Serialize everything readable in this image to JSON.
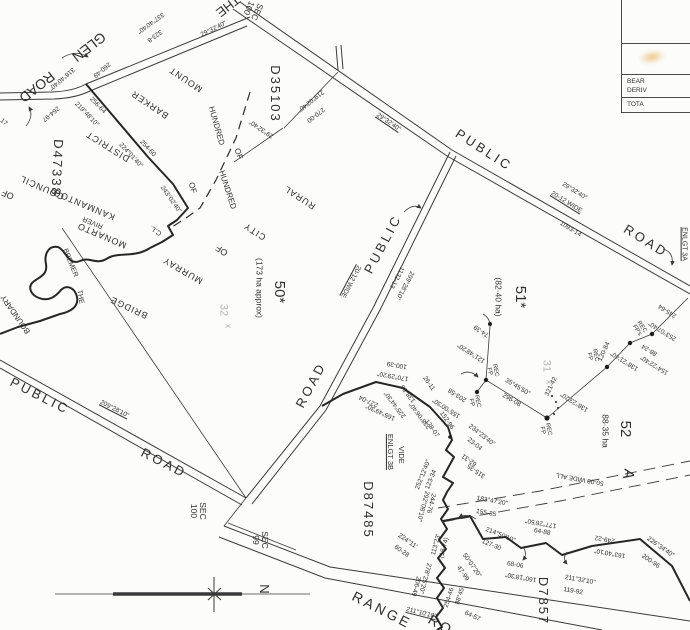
{
  "map": {
    "background": "#fcfcfb",
    "ink": "#2e2e2e",
    "faint_ink": "#b5b5b5",
    "smudge_color": "#e09628",
    "corner_table": {
      "row2_line1": "BEAR",
      "row2_line2": "DERIV",
      "row3": "TOTA"
    },
    "labels": [
      {
        "t": "THE",
        "x": 228,
        "y": 6,
        "r": 142,
        "s": 13
      },
      {
        "t": "GLEN",
        "x": 89,
        "y": 47,
        "r": 142,
        "s": 14
      },
      {
        "t": "ROAD",
        "x": 37,
        "y": 87,
        "r": 142,
        "s": 14
      },
      {
        "t": "337°40'40\"",
        "x": 150,
        "y": 22,
        "r": 144,
        "s": 6.5
      },
      {
        "t": "323-8",
        "x": 154,
        "y": 35,
        "r": 144,
        "s": 6.5
      },
      {
        "t": "316°40'40\"",
        "x": 61,
        "y": 78,
        "r": 140,
        "s": 6.5
      },
      {
        "t": "260-49",
        "x": 101,
        "y": 69,
        "r": 140,
        "s": 6.5
      },
      {
        "t": "264-97",
        "x": 50,
        "y": 113,
        "r": 140,
        "s": 6.5
      },
      {
        "t": "29°32'40\"",
        "x": 214,
        "y": 30,
        "r": -26,
        "s": 6.5
      },
      {
        "t": "SEC\n100",
        "x": 253,
        "y": 10,
        "r": 115,
        "s": 8.5
      },
      {
        "t": "D35103",
        "x": 275,
        "y": 94,
        "r": 90,
        "s": 13,
        "ls": 2
      },
      {
        "t": "219°02'40\"",
        "x": 310,
        "y": 100,
        "r": 142,
        "s": 6.5
      },
      {
        "t": "270-00",
        "x": 315,
        "y": 114,
        "r": 142,
        "s": 6.5
      },
      {
        "t": "29°32'40\"",
        "x": 262,
        "y": 128,
        "r": 214,
        "s": 6.5
      },
      {
        "t": "29°32'40\"",
        "x": 388,
        "y": 123,
        "r": 34,
        "s": 6.5,
        "u": 1
      },
      {
        "t": "PUBLIC",
        "x": 484,
        "y": 150,
        "r": 33,
        "s": 13,
        "ls": 3
      },
      {
        "t": "ROAD",
        "x": 646,
        "y": 241,
        "r": 32,
        "s": 13,
        "ls": 3
      },
      {
        "t": "29°32'40\"",
        "x": 574,
        "y": 192,
        "r": 32,
        "s": 6.5
      },
      {
        "t": "20-12 WIDE",
        "x": 566,
        "y": 203,
        "r": 32,
        "s": 6.5,
        "u": 1
      },
      {
        "t": "1093-14",
        "x": 570,
        "y": 230,
        "r": 32,
        "s": 6.5
      },
      {
        "t": "ENLGT 3A",
        "x": 684,
        "y": 244,
        "r": 90,
        "s": 7,
        "u": 1
      },
      {
        "t": "PUBLIC",
        "x": 383,
        "y": 244,
        "r": -62,
        "s": 13,
        "ls": 3
      },
      {
        "t": "ROAD",
        "x": 311,
        "y": 385,
        "r": -62,
        "s": 13,
        "ls": 3
      },
      {
        "t": "20-12 WIDE",
        "x": 350,
        "y": 281,
        "r": 118,
        "s": 6.5,
        "u": 1
      },
      {
        "t": "1132-13",
        "x": 396,
        "y": 277,
        "r": 118,
        "s": 6.5
      },
      {
        "t": "299°28'10\"",
        "x": 404,
        "y": 285,
        "r": 118,
        "s": 6.5
      },
      {
        "t": "PUBLIC",
        "x": 40,
        "y": 396,
        "r": 27,
        "s": 13,
        "ls": 3
      },
      {
        "t": "ROAD",
        "x": 164,
        "y": 463,
        "r": 27,
        "s": 13,
        "ls": 3
      },
      {
        "t": "209°28'10\"",
        "x": 114,
        "y": 410,
        "r": 27,
        "s": 6.5,
        "u": 1
      },
      {
        "t": "RANGE",
        "x": 382,
        "y": 610,
        "r": 27,
        "s": 14,
        "ls": 3
      },
      {
        "t": "RO",
        "x": 441,
        "y": 625,
        "r": 30,
        "s": 14,
        "ls": 3
      },
      {
        "t": "211°10'10\"",
        "x": 421,
        "y": 614,
        "r": 14,
        "s": 6.5,
        "u": 1
      },
      {
        "t": "50*",
        "x": 279,
        "y": 292,
        "r": 90,
        "s": 15
      },
      {
        "t": "(173 ha approx)",
        "x": 259,
        "y": 288,
        "r": 90,
        "s": 8.5
      },
      {
        "t": "51*",
        "x": 520,
        "y": 297,
        "r": 90,
        "s": 15
      },
      {
        "t": "(82·40 ha)",
        "x": 498,
        "y": 297,
        "r": 90,
        "s": 8.5
      },
      {
        "t": "52",
        "x": 625,
        "y": 429,
        "r": 90,
        "s": 15
      },
      {
        "t": "88·35 ha",
        "x": 605,
        "y": 431,
        "r": 90,
        "s": 8.5
      },
      {
        "t": "32",
        "x": 223,
        "y": 310,
        "r": 90,
        "s": 11,
        "c": "#b5b5b5"
      },
      {
        "t": "x",
        "x": 228,
        "y": 326,
        "r": 90,
        "s": 9,
        "c": "#b5b5b5"
      },
      {
        "t": "31",
        "x": 546,
        "y": 366,
        "r": 90,
        "s": 11,
        "c": "#b5b5b5"
      },
      {
        "t": "x",
        "x": 549,
        "y": 382,
        "r": 90,
        "s": 9,
        "c": "#b5b5b5"
      },
      {
        "t": "SEC\n100",
        "x": 198,
        "y": 511,
        "r": 90,
        "s": 8.5
      },
      {
        "t": "SEC\n99",
        "x": 260,
        "y": 540,
        "r": 90,
        "s": 8.5
      },
      {
        "t": "D47338",
        "x": 57,
        "y": 168,
        "r": 93,
        "s": 13,
        "ls": 2
      },
      {
        "t": "D87485",
        "x": 368,
        "y": 510,
        "r": 90,
        "s": 13,
        "ls": 2
      },
      {
        "t": "D7857",
        "x": 543,
        "y": 601,
        "r": 90,
        "s": 13,
        "ls": 2
      },
      {
        "t": "VIDE",
        "x": 401,
        "y": 455,
        "r": 90,
        "s": 7.5
      },
      {
        "t": "ENLGT 3B",
        "x": 390,
        "y": 452,
        "r": 90,
        "s": 7.5,
        "u": 1
      },
      {
        "t": "A",
        "x": 628,
        "y": 474,
        "r": 100,
        "s": 15
      },
      {
        "t": "50-00 WIDE ALL",
        "x": 580,
        "y": 478,
        "r": 190,
        "s": 6.5
      },
      {
        "t": "MOUNT",
        "x": 186,
        "y": 79,
        "r": 214,
        "s": 9,
        "ls": 1
      },
      {
        "t": "BARKER",
        "x": 150,
        "y": 104,
        "r": 214,
        "s": 9,
        "ls": 1
      },
      {
        "t": "DISTRICT",
        "x": 108,
        "y": 146,
        "r": 212,
        "s": 9,
        "ls": 1
      },
      {
        "t": "COUNCIL",
        "x": 42,
        "y": 187,
        "r": 204,
        "s": 9,
        "ls": 1
      },
      {
        "t": "OF",
        "x": 8,
        "y": 194,
        "r": 204,
        "s": 9
      },
      {
        "t": "HUNDRED",
        "x": 216,
        "y": 126,
        "r": 74,
        "s": 8
      },
      {
        "t": "OF",
        "x": 238,
        "y": 154,
        "r": 72,
        "s": 8
      },
      {
        "t": "HUNDRED",
        "x": 227,
        "y": 190,
        "r": 72,
        "s": 8
      },
      {
        "t": "OF",
        "x": 192,
        "y": 188,
        "r": 74,
        "s": 8
      },
      {
        "t": "KANMANTOO",
        "x": 84,
        "y": 204,
        "r": 203,
        "s": 9,
        "ls": 1
      },
      {
        "t": "MONARTO",
        "x": 102,
        "y": 235,
        "r": 203,
        "s": 9,
        "ls": 1
      },
      {
        "t": "RIVER",
        "x": 93,
        "y": 222,
        "r": 203,
        "s": 7
      },
      {
        "t": "BREMER",
        "x": 70,
        "y": 263,
        "r": 68,
        "s": 7
      },
      {
        "t": "THE",
        "x": 80,
        "y": 297,
        "r": 80,
        "s": 7
      },
      {
        "t": "BOUNDARY",
        "x": 16,
        "y": 314,
        "r": 235,
        "s": 8
      },
      {
        "t": "C.L.",
        "x": 156,
        "y": 230,
        "r": 214,
        "s": 7
      },
      {
        "t": "RURAL",
        "x": 300,
        "y": 197,
        "r": 213,
        "s": 9,
        "ls": 1
      },
      {
        "t": "CITY",
        "x": 255,
        "y": 231,
        "r": 213,
        "s": 9,
        "ls": 1
      },
      {
        "t": "OF",
        "x": 222,
        "y": 250,
        "r": 213,
        "s": 9
      },
      {
        "t": "MURRAY",
        "x": 183,
        "y": 270,
        "r": 210,
        "s": 9,
        "ls": 1
      },
      {
        "t": "BRIDGE",
        "x": 129,
        "y": 307,
        "r": 205,
        "s": 9,
        "ls": 1
      },
      {
        "t": "243°02'40\"",
        "x": 170,
        "y": 200,
        "r": 55,
        "s": 6.5
      },
      {
        "t": "256-64",
        "x": 97,
        "y": 106,
        "r": 46,
        "s": 6.5
      },
      {
        "t": "219°48'10\"",
        "x": 86,
        "y": 115,
        "r": 46,
        "s": 6.5
      },
      {
        "t": "254-60",
        "x": 147,
        "y": 149,
        "r": 47,
        "s": 6.5
      },
      {
        "t": "224°01'40\"",
        "x": 130,
        "y": 156,
        "r": 47,
        "s": 6.5
      },
      {
        "t": "17",
        "x": 3,
        "y": 123,
        "r": 40,
        "s": 6.5
      },
      {
        "t": "170°29'20\"",
        "x": 393,
        "y": 375,
        "r": 190,
        "s": 6.5
      },
      {
        "t": "100-39",
        "x": 397,
        "y": 364,
        "r": 190,
        "s": 6.5
      },
      {
        "t": "227-04",
        "x": 369,
        "y": 400,
        "r": 205,
        "s": 6.5
      },
      {
        "t": "165°49'30\"",
        "x": 381,
        "y": 411,
        "r": 205,
        "s": 6.5
      },
      {
        "t": "138-86",
        "x": 409,
        "y": 393,
        "r": 233,
        "s": 6.5
      },
      {
        "t": "225°44'30\"",
        "x": 396,
        "y": 404,
        "r": 233,
        "s": 6.5
      },
      {
        "t": "238°06'40\"",
        "x": 421,
        "y": 415,
        "r": 233,
        "s": 6.5
      },
      {
        "t": "26-11",
        "x": 428,
        "y": 384,
        "r": 55,
        "s": 6.5
      },
      {
        "t": "203-58",
        "x": 458,
        "y": 394,
        "r": 213,
        "s": 6.5
      },
      {
        "t": "155°00'30\"",
        "x": 447,
        "y": 407,
        "r": 213,
        "s": 6.5
      },
      {
        "t": "152-96",
        "x": 446,
        "y": 421,
        "r": 55,
        "s": 6.5
      },
      {
        "t": "179-07",
        "x": 431,
        "y": 429,
        "r": 55,
        "s": 6.5
      },
      {
        "t": "121°48'20\"",
        "x": 472,
        "y": 352,
        "r": 213,
        "s": 6.5
      },
      {
        "t": "74-39",
        "x": 482,
        "y": 330,
        "r": 213,
        "s": 6.5
      },
      {
        "t": "35°45'50\"",
        "x": 517,
        "y": 388,
        "r": 31,
        "s": 6.5
      },
      {
        "t": "296-08",
        "x": 511,
        "y": 401,
        "r": 31,
        "s": 6.5
      },
      {
        "t": "321-42",
        "x": 552,
        "y": 387,
        "r": -65,
        "s": 6.5
      },
      {
        "t": "138°23'20\"",
        "x": 575,
        "y": 401,
        "r": 212,
        "s": 6.5
      },
      {
        "t": "120-84",
        "x": 605,
        "y": 352,
        "r": -65,
        "s": 6.5
      },
      {
        "t": "138°21'40\"",
        "x": 625,
        "y": 360,
        "r": 212,
        "s": 6.5
      },
      {
        "t": "88-24",
        "x": 650,
        "y": 349,
        "r": 212,
        "s": 6.5
      },
      {
        "t": "154°22'40\"",
        "x": 655,
        "y": 364,
        "r": 212,
        "s": 6.5
      },
      {
        "t": "245-64",
        "x": 668,
        "y": 310,
        "r": 212,
        "s": 6.5
      },
      {
        "t": "253°07'40\"",
        "x": 663,
        "y": 330,
        "r": 212,
        "s": 6.5
      },
      {
        "t": "REC\nFP",
        "x": 492,
        "y": 371,
        "r": 78,
        "s": 6
      },
      {
        "t": "REC\nFP",
        "x": 474,
        "y": 402,
        "r": 78,
        "s": 6
      },
      {
        "t": "REC\nFP",
        "x": 545,
        "y": 430,
        "r": 78,
        "s": 6
      },
      {
        "t": "REC\nFP",
        "x": 592,
        "y": 356,
        "r": 78,
        "s": 6
      },
      {
        "t": "REC\nFP's",
        "x": 639,
        "y": 329,
        "r": 56,
        "s": 6
      },
      {
        "t": "234°23'40\"",
        "x": 481,
        "y": 436,
        "r": 38,
        "s": 6.5
      },
      {
        "t": "23-04",
        "x": 474,
        "y": 445,
        "r": 38,
        "s": 6.5
      },
      {
        "t": "62-31",
        "x": 470,
        "y": 459,
        "r": 215,
        "s": 6.5
      },
      {
        "t": "315-35",
        "x": 477,
        "y": 470,
        "r": 215,
        "s": 6.5
      },
      {
        "t": "183°47'20\"",
        "x": 492,
        "y": 502,
        "r": 10,
        "s": 6.5
      },
      {
        "t": "155-35",
        "x": 486,
        "y": 514,
        "r": 10,
        "s": 6.5
      },
      {
        "t": "214°50'10\"",
        "x": 500,
        "y": 536,
        "r": 22,
        "s": 6.5
      },
      {
        "t": "127-30",
        "x": 491,
        "y": 546,
        "r": 22,
        "s": 6.5
      },
      {
        "t": "177°26'50\"",
        "x": 541,
        "y": 522,
        "r": 190,
        "s": 6.5
      },
      {
        "t": "64-88",
        "x": 542,
        "y": 533,
        "r": 10,
        "s": 6.5
      },
      {
        "t": "249-22",
        "x": 605,
        "y": 538,
        "r": 190,
        "s": 6.5
      },
      {
        "t": "163°40'10\"",
        "x": 610,
        "y": 552,
        "r": 190,
        "s": 6.5
      },
      {
        "t": "226°34'40\"",
        "x": 660,
        "y": 548,
        "r": 35,
        "s": 6.5
      },
      {
        "t": "200-96",
        "x": 650,
        "y": 562,
        "r": 35,
        "s": 6.5
      },
      {
        "t": "211°32'10\"",
        "x": 580,
        "y": 581,
        "r": 10,
        "s": 6.5
      },
      {
        "t": "119-92",
        "x": 573,
        "y": 592,
        "r": 10,
        "s": 6.5
      },
      {
        "t": "160°18'30\"",
        "x": 521,
        "y": 576,
        "r": 190,
        "s": 6.5
      },
      {
        "t": "68-06",
        "x": 515,
        "y": 566,
        "r": 10,
        "s": 6.5
      },
      {
        "t": "50°07'20\"",
        "x": 471,
        "y": 566,
        "r": 55,
        "s": 6.5
      },
      {
        "t": "47-99",
        "x": 462,
        "y": 574,
        "r": 55,
        "s": 6.5
      },
      {
        "t": "88°45'",
        "x": 461,
        "y": 596,
        "r": -72,
        "s": 6.5
      },
      {
        "t": "254-46",
        "x": 450,
        "y": 598,
        "r": -72,
        "s": 6.5
      },
      {
        "t": "64-57",
        "x": 472,
        "y": 617,
        "r": 25,
        "s": 6.5
      },
      {
        "t": "113°23'",
        "x": 437,
        "y": 545,
        "r": -75,
        "s": 6.5
      },
      {
        "t": "(18-74)",
        "x": 445,
        "y": 548,
        "r": -75,
        "s": 6.5
      },
      {
        "t": "292°08'10\"",
        "x": 422,
        "y": 506,
        "r": 105,
        "s": 6.5
      },
      {
        "t": "244-76",
        "x": 430,
        "y": 503,
        "r": 105,
        "s": 6.5
      },
      {
        "t": "224°11'",
        "x": 407,
        "y": 542,
        "r": 35,
        "s": 6.5
      },
      {
        "t": "60-28",
        "x": 401,
        "y": 552,
        "r": 35,
        "s": 6.5
      },
      {
        "t": "278°25'20\"",
        "x": 424,
        "y": 578,
        "r": 105,
        "s": 6.5
      },
      {
        "t": "206-49",
        "x": 415,
        "y": 586,
        "r": 105,
        "s": 6.5
      },
      {
        "t": "252°12'40\"",
        "x": 424,
        "y": 475,
        "r": -68,
        "s": 6.5
      },
      {
        "t": "123-34",
        "x": 432,
        "y": 480,
        "r": -68,
        "s": 6.5
      },
      {
        "t": "N",
        "x": 264,
        "y": 589,
        "r": 90,
        "s": 13
      }
    ]
  }
}
